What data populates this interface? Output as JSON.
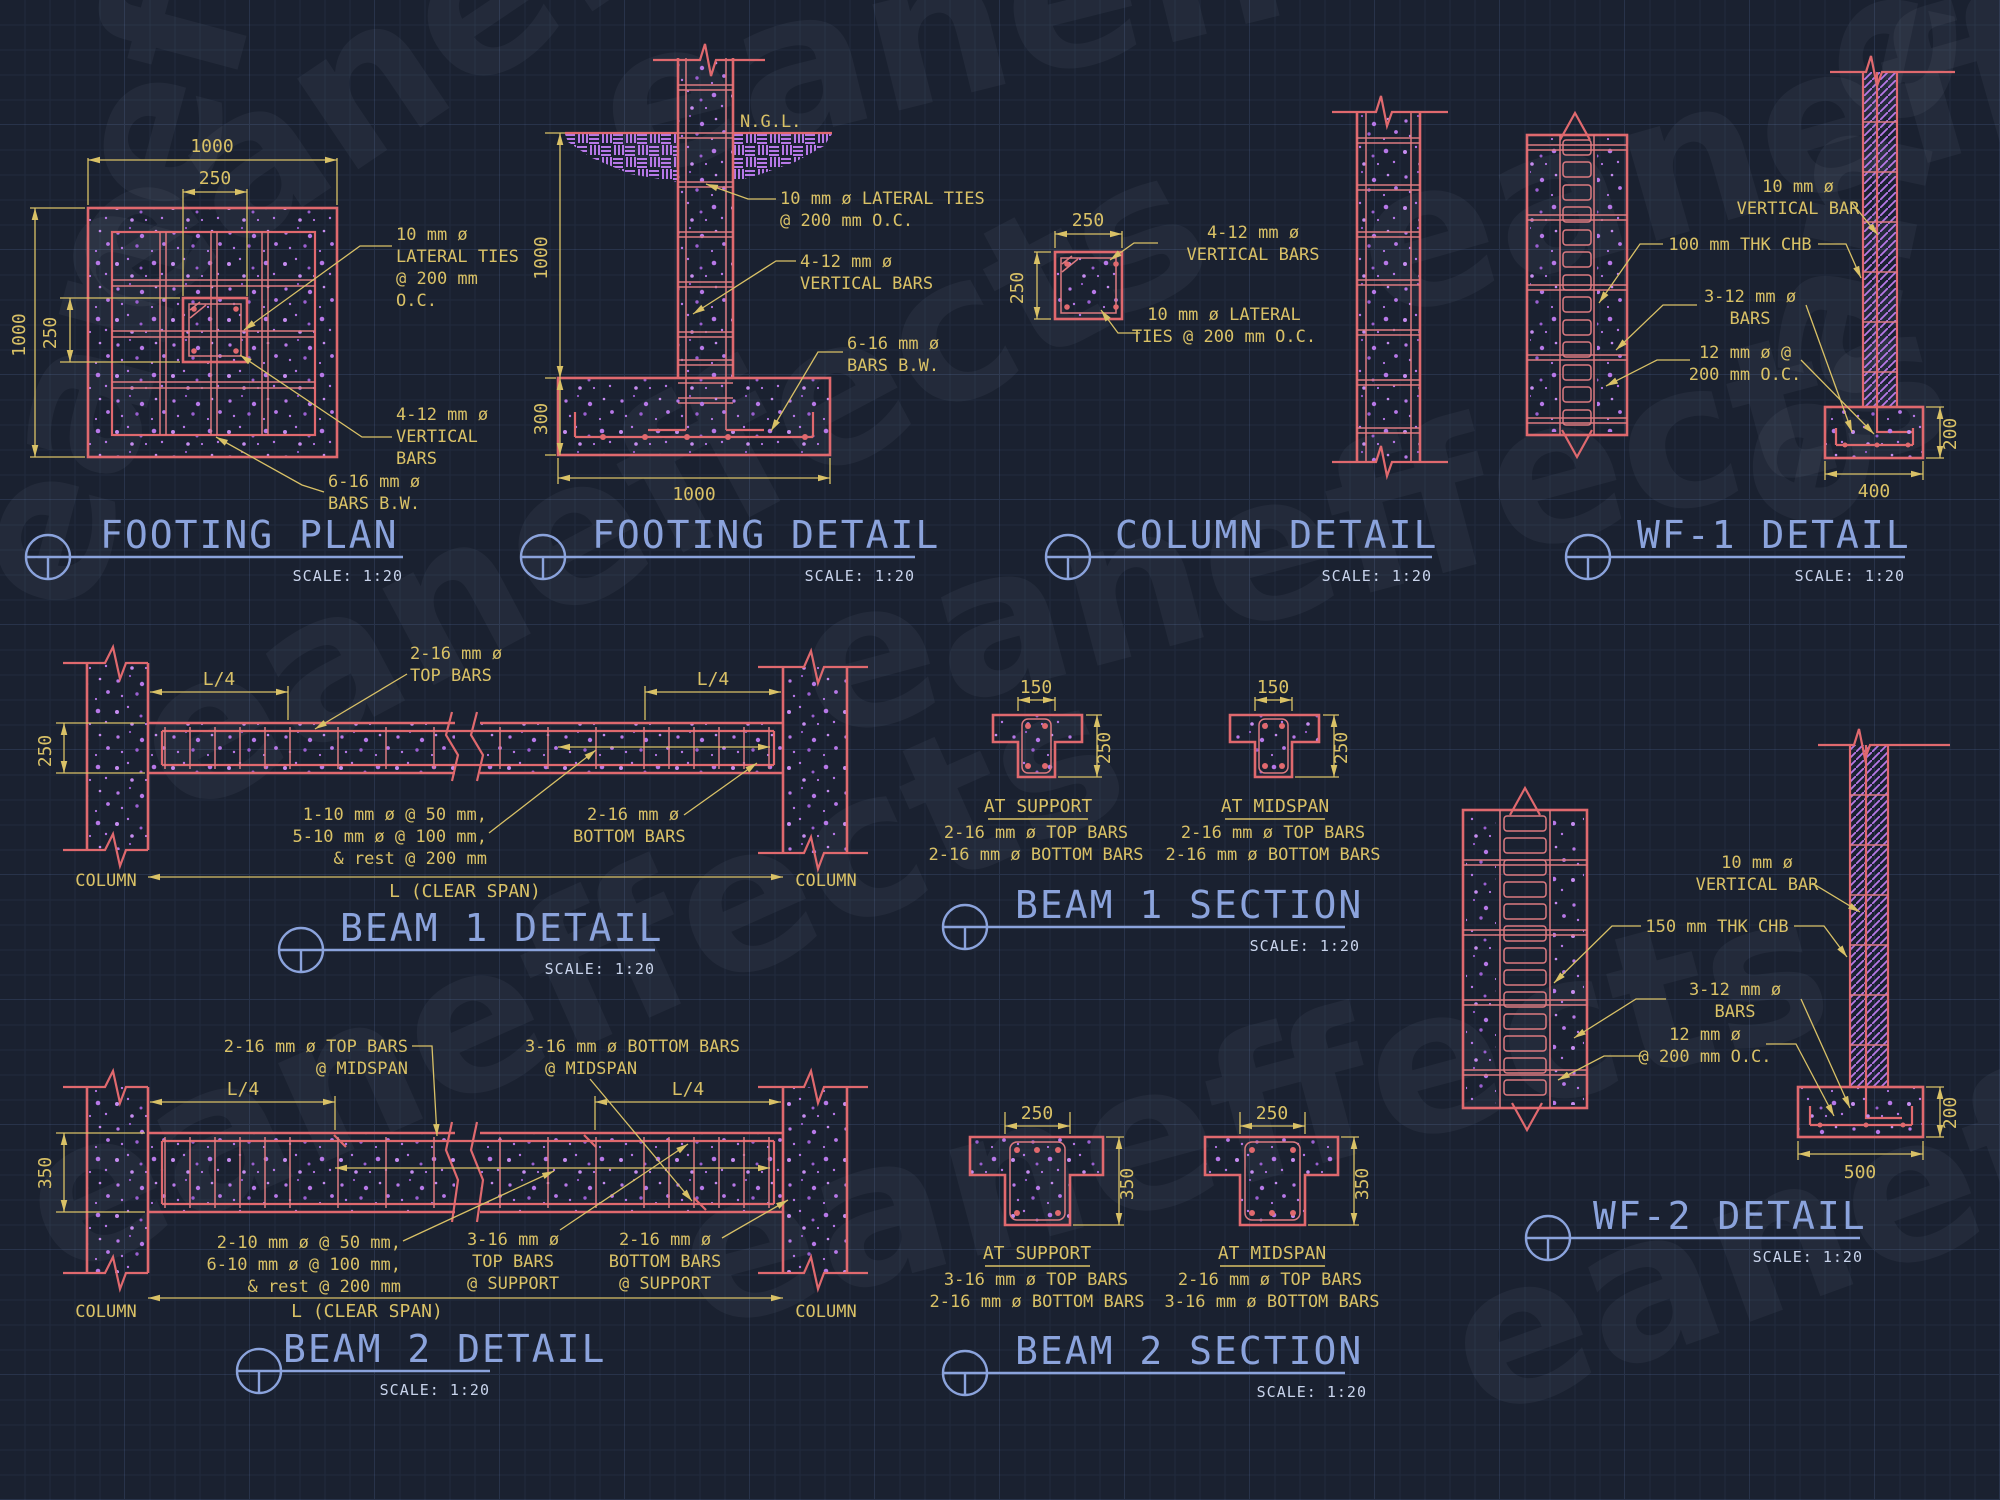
{
  "watermark": {
    "text": "eaneffects"
  },
  "colors": {
    "background": "#1a2130",
    "line_red": "#e0696e",
    "hatch_purple": "#b778e8",
    "dim_yellow": "#d9c166",
    "title_blue": "#8ba3dc",
    "scale_white": "#c9d4ec"
  },
  "footing_plan": {
    "title": "FOOTING PLAN",
    "scale": "SCALE:  1:20",
    "dim_width": "1000",
    "dim_col_width": "250",
    "dim_height": "1000",
    "dim_col_height": "250",
    "ann_ties": [
      "10 mm ø",
      "LATERAL TIES",
      "@ 200 mm",
      "O.C."
    ],
    "ann_vbars": [
      "4-12 mm ø",
      "VERTICAL",
      "BARS"
    ],
    "ann_bw": [
      "6-16 mm ø",
      "BARS B.W."
    ]
  },
  "footing_detail": {
    "title": "FOOTING DETAIL",
    "scale": "SCALE:  1:20",
    "ngl": "N.G.L.",
    "dim_depth": "1000",
    "dim_footing": "300",
    "dim_width": "1000",
    "ann_ties": [
      "10 mm ø LATERAL TIES",
      "@ 200 mm O.C."
    ],
    "ann_vbars": [
      "4-12 mm ø",
      "VERTICAL BARS"
    ],
    "ann_bw": [
      "6-16 mm ø",
      "BARS B.W."
    ]
  },
  "column_detail": {
    "title": "COLUMN DETAIL",
    "scale": "SCALE:  1:20",
    "dim_width": "250",
    "dim_height": "250",
    "ann_vbars": [
      "4-12 mm ø",
      "VERTICAL BARS"
    ],
    "ann_ties": [
      "10 mm ø LATERAL",
      "TIES @ 200 mm O.C."
    ]
  },
  "wf1_detail": {
    "title": "WF-1 DETAIL",
    "scale": "SCALE:  1:20",
    "ann_vbar": [
      "10 mm ø",
      "VERTICAL BAR"
    ],
    "ann_chb": "100 mm THK CHB",
    "ann_bars": [
      "3-12 mm ø",
      "BARS"
    ],
    "ann_oc": [
      "12 mm ø @",
      "200 mm O.C."
    ],
    "dim_depth": "200",
    "dim_width": "400"
  },
  "beam1_detail": {
    "title": "BEAM 1 DETAIL",
    "scale": "SCALE:  1:20",
    "dim_height": "250",
    "dim_l4_left": "L/4",
    "dim_l4_right": "L/4",
    "dim_span": "L (CLEAR SPAN)",
    "col_left": "COLUMN",
    "col_right": "COLUMN",
    "ann_top": [
      "2-16 mm ø",
      "TOP BARS"
    ],
    "ann_stirrups": [
      "1-10 mm ø @ 50 mm,",
      "5-10 mm ø @ 100 mm,",
      "& rest @ 200 mm"
    ],
    "ann_bottom": [
      "2-16 mm ø",
      "BOTTOM BARS"
    ]
  },
  "beam1_section": {
    "title": "BEAM 1 SECTION",
    "scale": "SCALE:  1:20",
    "support": {
      "label": "AT SUPPORT",
      "dim_width": "150",
      "dim_height": "250",
      "notes": [
        "2-16 mm ø TOP BARS",
        "2-16 mm ø BOTTOM BARS"
      ]
    },
    "midspan": {
      "label": "AT MIDSPAN",
      "dim_width": "150",
      "dim_height": "250",
      "notes": [
        "2-16 mm ø TOP BARS",
        "2-16 mm ø BOTTOM BARS"
      ]
    }
  },
  "beam2_detail": {
    "title": "BEAM 2 DETAIL",
    "scale": "SCALE:  1:20",
    "dim_height": "350",
    "dim_l4_left": "L/4",
    "dim_l4_right": "L/4",
    "dim_span": "L (CLEAR SPAN)",
    "col_left": "COLUMN",
    "col_right": "COLUMN",
    "ann_topmid": [
      "2-16 mm ø TOP BARS",
      "@ MIDSPAN"
    ],
    "ann_botmid": [
      "3-16 mm ø BOTTOM BARS",
      "@ MIDSPAN"
    ],
    "ann_stirrups": [
      "2-10 mm ø @ 50 mm,",
      "6-10 mm ø @ 100 mm,",
      "& rest @ 200 mm"
    ],
    "ann_topsup": [
      "3-16 mm ø",
      "TOP BARS",
      "@ SUPPORT"
    ],
    "ann_botsup": [
      "2-16 mm ø",
      "BOTTOM BARS",
      "@ SUPPORT"
    ]
  },
  "beam2_section": {
    "title": "BEAM 2 SECTION",
    "scale": "SCALE:  1:20",
    "support": {
      "label": "AT SUPPORT",
      "dim_width": "250",
      "dim_height": "350",
      "notes": [
        "3-16 mm ø TOP BARS",
        "2-16 mm ø BOTTOM BARS"
      ]
    },
    "midspan": {
      "label": "AT MIDSPAN",
      "dim_width": "250",
      "dim_height": "350",
      "notes": [
        "2-16 mm ø TOP BARS",
        "3-16 mm ø BOTTOM BARS"
      ]
    }
  },
  "wf2_detail": {
    "title": "WF-2 DETAIL",
    "scale": "SCALE:  1:20",
    "ann_vbar": [
      "10 mm ø",
      "VERTICAL BAR"
    ],
    "ann_chb": "150 mm THK CHB",
    "ann_bars": [
      "3-12 mm ø",
      "BARS"
    ],
    "ann_oc": [
      "12 mm ø",
      "@ 200 mm O.C."
    ],
    "dim_depth": "200",
    "dim_width": "500"
  }
}
